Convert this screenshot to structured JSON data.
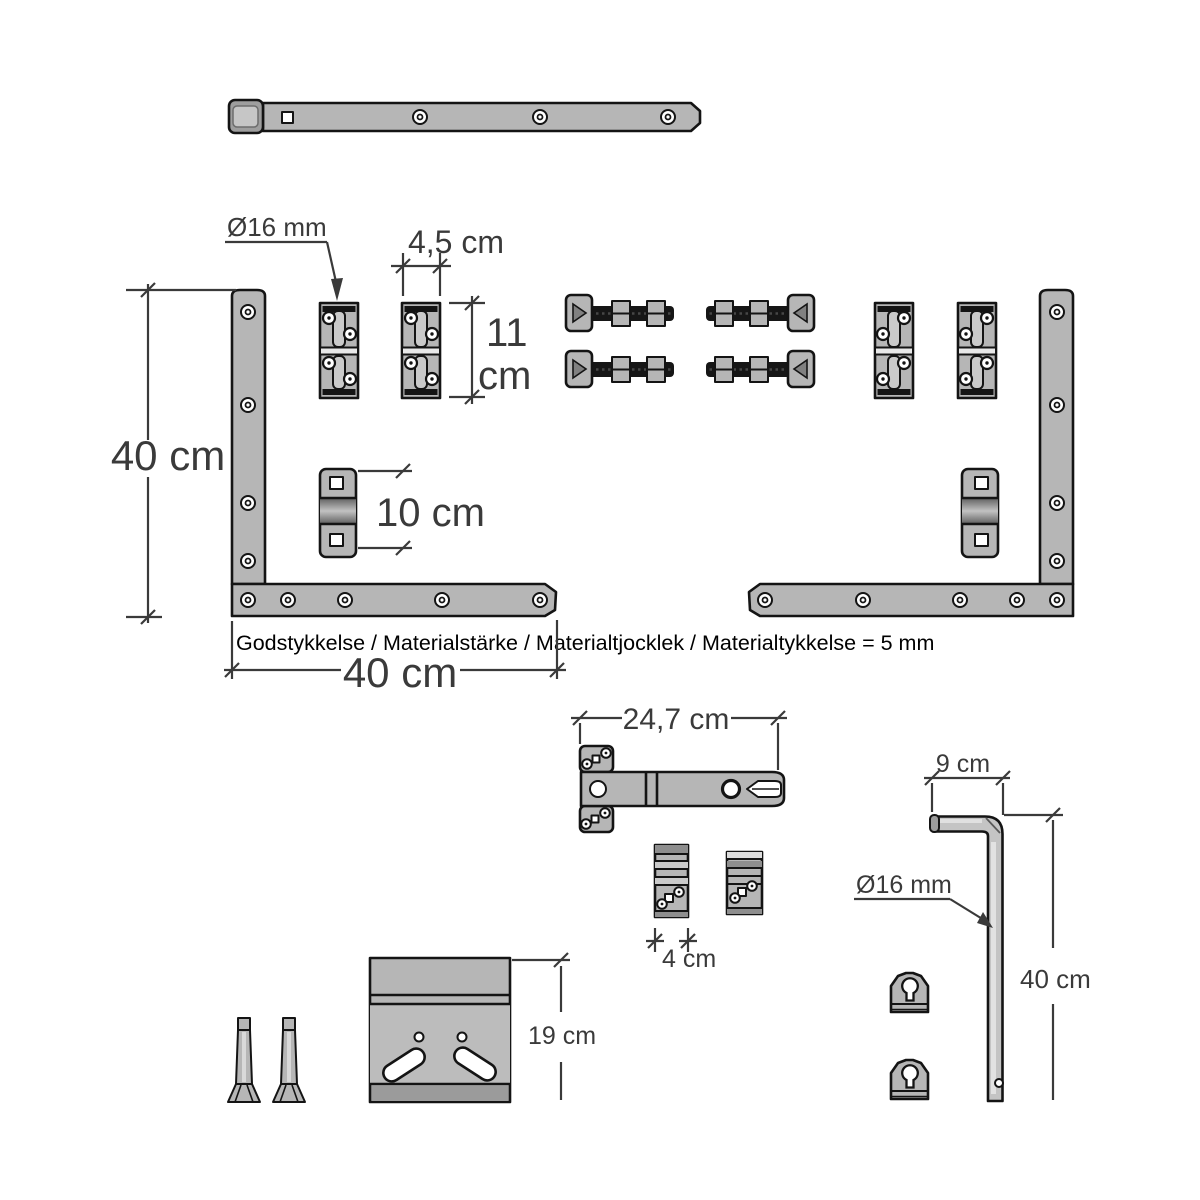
{
  "diagram": {
    "labels": {
      "pin_diameter_top": "Ø16 mm",
      "hinge_width": "4,5 cm",
      "hinge_height_value": "11",
      "hinge_height_unit": "cm",
      "frame_height": "40 cm",
      "wall_plate_length": "10 cm",
      "material_note": "Godstykkelse / Materialstärke / Materialtjocklek / Materialtykkelse = 5 mm",
      "frame_width": "40 cm",
      "strap_length": "24,7 cm",
      "hook_arm_length": "9 cm",
      "pin_diameter_bottom": "Ø16 mm",
      "clip_width": "4 cm",
      "mount_plate_height": "19 cm",
      "hook_pin_length": "40 cm"
    },
    "colors": {
      "steel": "#b6b6b6",
      "steel_light": "#cacaca",
      "steel_dark": "#8e8e8e",
      "outline": "#141414",
      "dim": "#3a3a3a",
      "background": "#ffffff"
    }
  }
}
